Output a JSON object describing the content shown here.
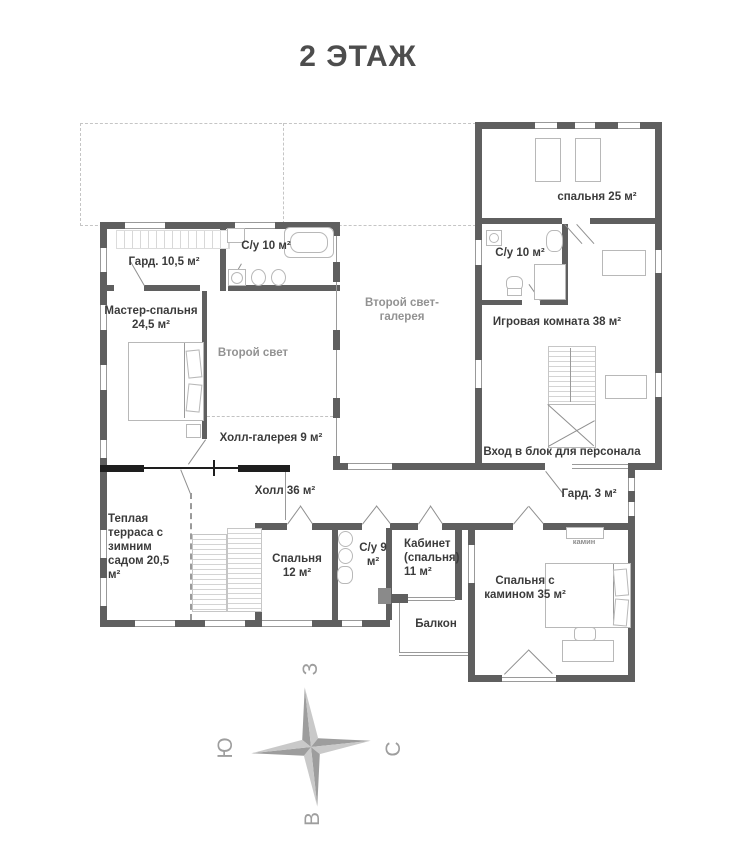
{
  "title": "2 ЭТАЖ",
  "rooms": {
    "wardrobe_105": {
      "label": "Гард. 10,5 м²"
    },
    "bath_10_left": {
      "label": "С/у 10 м²"
    },
    "master_bedroom": {
      "label": "Мастер-спальня 24,5 м²"
    },
    "second_light": {
      "label": "Второй свет"
    },
    "hall_gallery": {
      "label": "Холл-галерея 9 м²"
    },
    "second_light_gallery": {
      "label": "Второй свет-галерея"
    },
    "bedroom_25": {
      "label": "спальня 25 м²"
    },
    "bath_10_right": {
      "label": "С/у 10 м²"
    },
    "game_room": {
      "label": "Игровая комната 38 м²"
    },
    "staff_entrance": {
      "label": "Вход в блок для персонала"
    },
    "hall_36": {
      "label": "Холл 36 м²"
    },
    "wardrobe_3": {
      "label": "Гард. 3 м²"
    },
    "warm_terrace": {
      "label": "Теплая терраса с зимним садом 20,5 м²"
    },
    "bedroom_12": {
      "label": "Спальня 12 м²"
    },
    "bath_9": {
      "label": "С/у 9 м²"
    },
    "cabinet_11": {
      "label": "Кабинет (спальня) 11 м²"
    },
    "balcony": {
      "label": "Балкон"
    },
    "bedroom_fireplace": {
      "label": "Спальня с камином 35 м²"
    },
    "fireplace": {
      "label": "камин"
    }
  },
  "compass": {
    "west": "З",
    "south": "Ю",
    "north": "С",
    "east": "В"
  },
  "colors": {
    "wall": "#5f5f5f",
    "wall_black": "#1e1e1e",
    "label": "#3b3b3b",
    "label_muted": "#929292",
    "furniture_line": "#b8b8b8",
    "compass_dark": "#9d9d9d",
    "compass_light": "#c9c9c9"
  }
}
